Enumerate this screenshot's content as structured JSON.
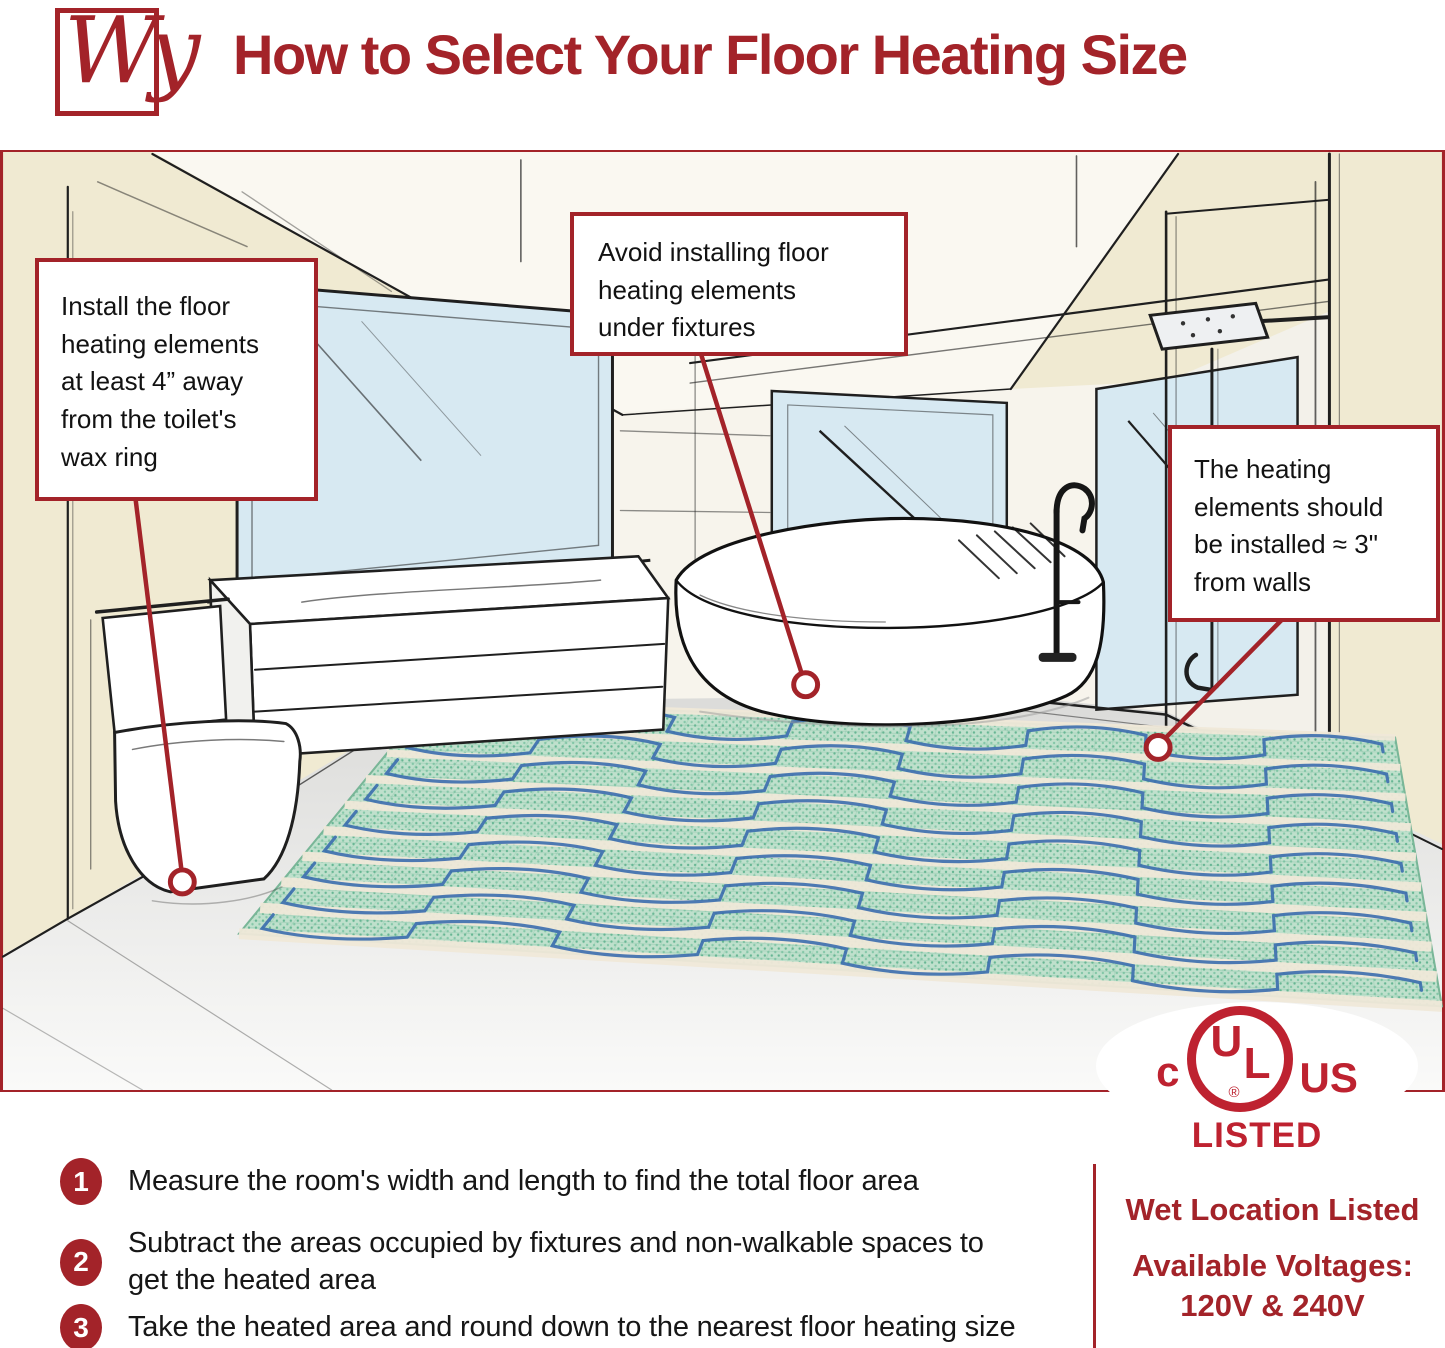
{
  "brand": {
    "logo_text": "Wy"
  },
  "header": {
    "title": "How to Select Your Floor Heating Size"
  },
  "callouts": [
    {
      "id": "toilet-clearance",
      "text": "Install the floor\nheating elements\nat least 4” away\nfrom the toilet's\nwax ring"
    },
    {
      "id": "avoid-fixtures",
      "text": "Avoid installing floor\nheating elements\nunder fixtures"
    },
    {
      "id": "wall-clearance",
      "text": "The heating\nelements should\nbe installed ≈ 3\"\nfrom walls"
    }
  ],
  "steps": [
    {
      "number": "1",
      "text": "Measure the room's width and length to find the total floor area"
    },
    {
      "number": "2",
      "text": "Subtract the areas occupied by fixtures and non-walkable spaces to\nget the heated area"
    },
    {
      "number": "3",
      "text": "Take the heated area and round down to the nearest floor heating size"
    }
  ],
  "certification": {
    "ul_c": "c",
    "ul_u": "U",
    "ul_l": "L",
    "ul_r": "®",
    "ul_us": "US",
    "listed": "LISTED",
    "wet_location": "Wet Location Listed",
    "voltages_label": "Available Voltages:",
    "voltages_value": "120V & 240V"
  },
  "colors": {
    "accent": "#A32329",
    "ul_red": "#BE2230",
    "wall_cream": "#F0EAD2",
    "window_blue": "#D7E9F2",
    "mat_green": "#BFE0CC",
    "cable_blue": "#3B6DAE",
    "tape_cream": "#EFE8D8",
    "floor_gray": "#DEDEDC"
  }
}
